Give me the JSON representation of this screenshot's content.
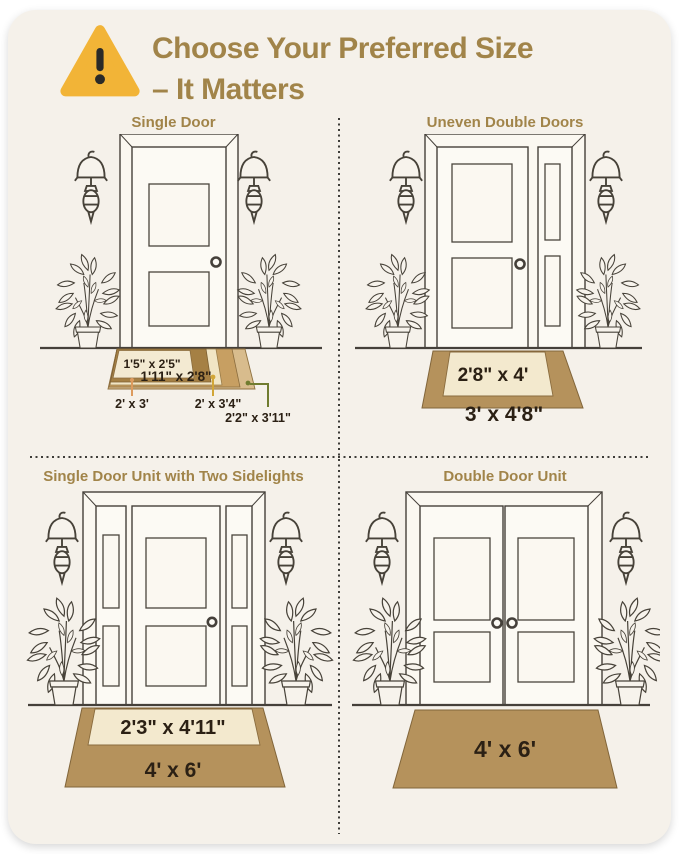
{
  "header": {
    "title_line1": "Choose Your Preferred Size",
    "title_line2": "– It Matters"
  },
  "colors": {
    "card_bg": "#f5f1ea",
    "title_tan": "#a18449",
    "warning_yellow": "#f2b437",
    "mat_brown": "#b5925c",
    "mat_cream": "#f3e9ce",
    "leader_orange": "#dd9b5e",
    "leader_yellow": "#d2a637",
    "leader_olive": "#707c2f"
  },
  "quadrants": {
    "single_door": {
      "title": "Single Door",
      "mats": {
        "size_1": "1'5\" x 2'5\"",
        "size_2": "1'11\" x 2'8\"",
        "size_3": "2' x 3'",
        "size_4": "2' x 3'4\"",
        "size_5": "2'2\" x 3'11\""
      }
    },
    "uneven_double_doors": {
      "title": "Uneven Double Doors",
      "mats": {
        "inner": "2'8\" x 4'",
        "outer": "3' x 4'8\""
      }
    },
    "single_door_sidelights": {
      "title": "Single Door Unit with Two Sidelights",
      "mats": {
        "inner": "2'3\" x 4'11\"",
        "outer": "4' x 6'"
      }
    },
    "double_door": {
      "title": "Double Door Unit",
      "mats": {
        "outer": "4' x 6'"
      }
    }
  }
}
